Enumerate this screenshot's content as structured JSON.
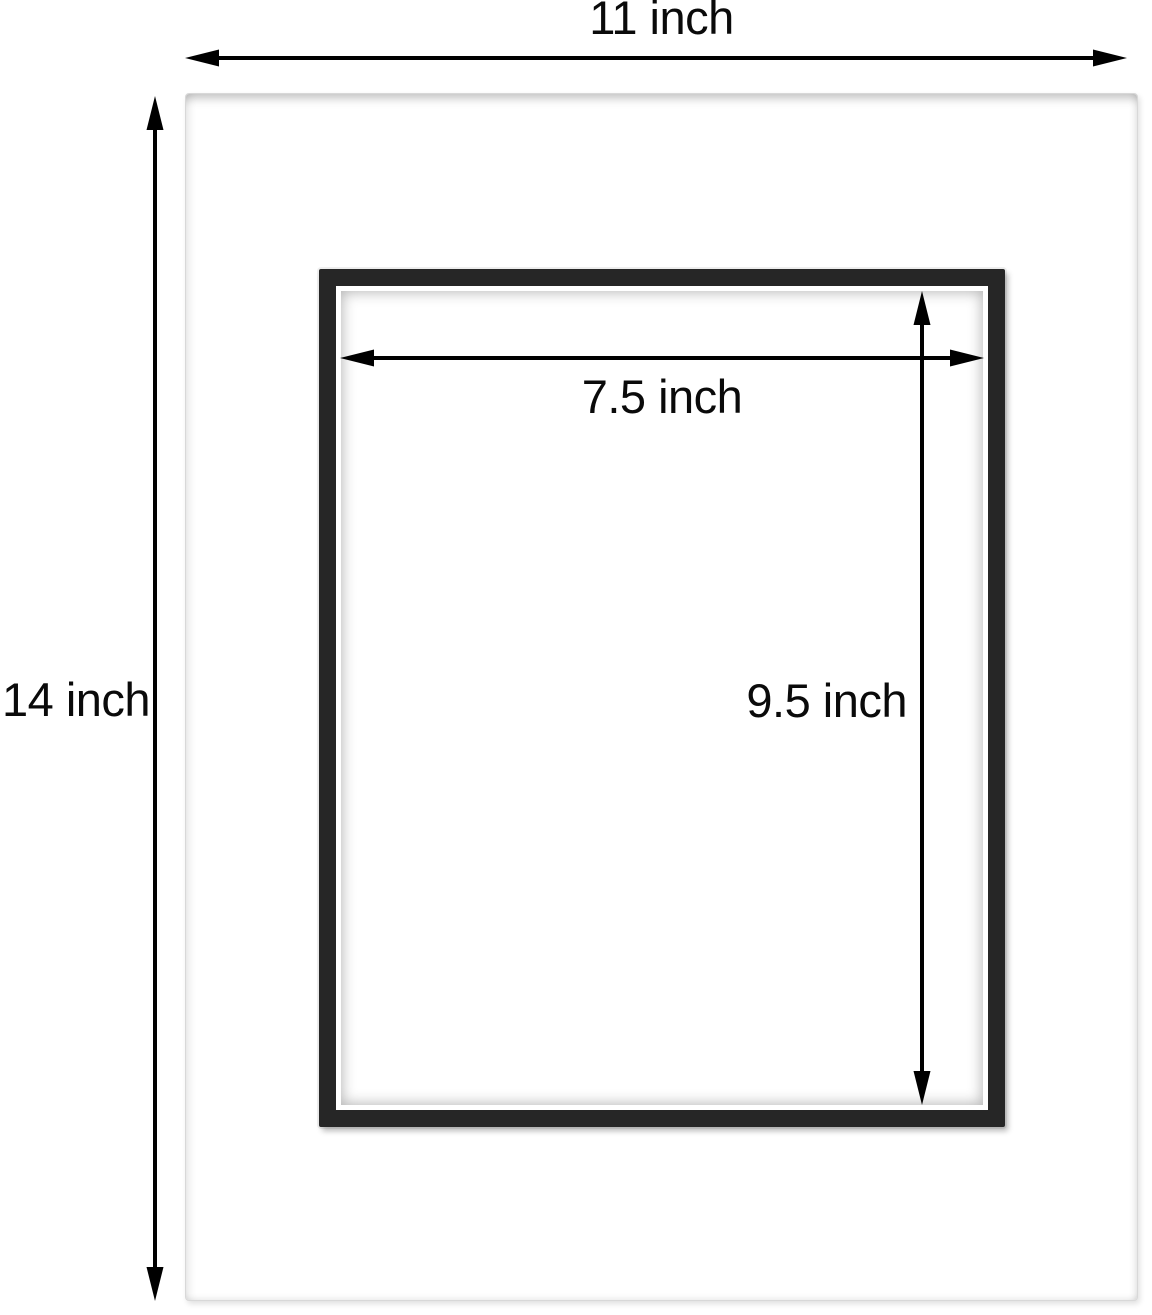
{
  "diagram": {
    "outer": {
      "width_label": "11 inch",
      "height_label": "14 inch"
    },
    "opening": {
      "width_label": "7.5 inch",
      "height_label": "9.5 inch"
    },
    "colors": {
      "background": "#ffffff",
      "mat_surface": "#ffffff",
      "mat_edge": "#d8d8d8",
      "frame_border": "#262626",
      "dimension_lines": "#000000",
      "text": "#0a0a0a"
    }
  }
}
